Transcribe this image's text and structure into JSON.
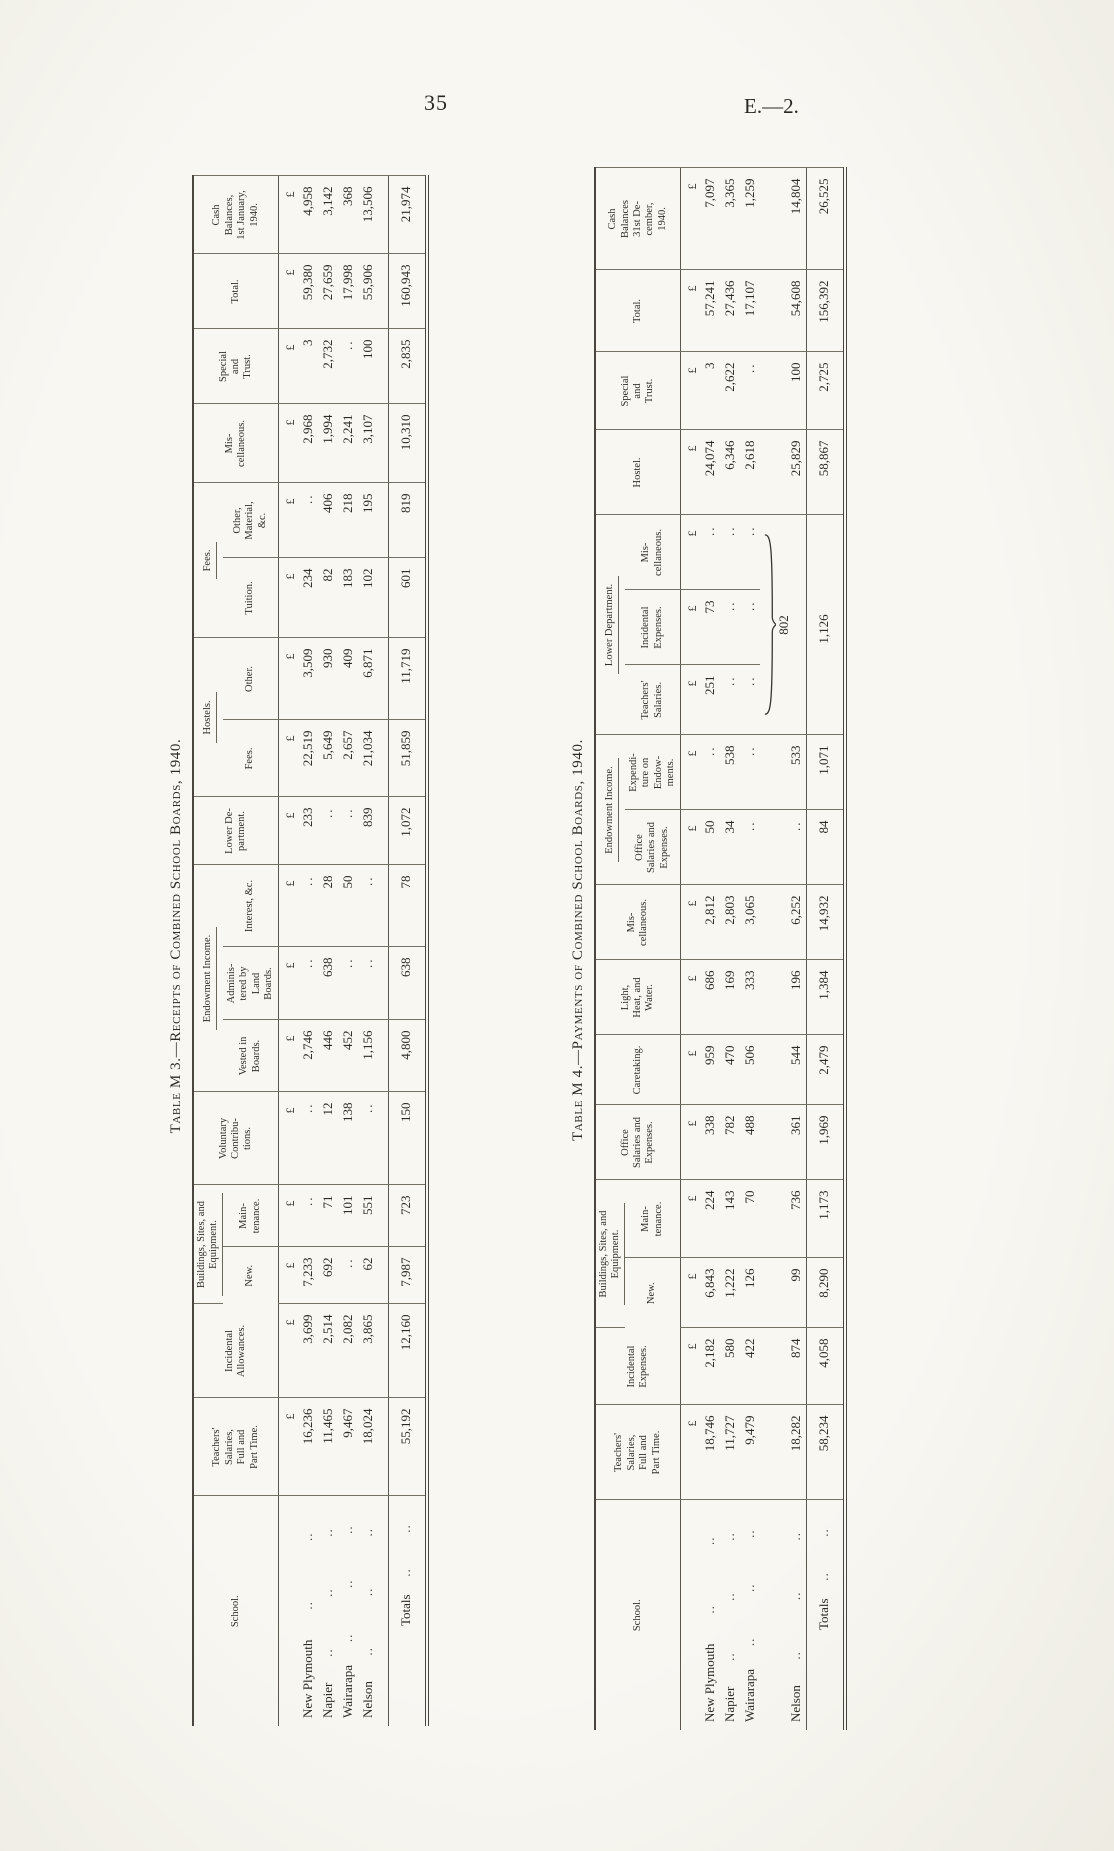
{
  "page": {
    "number": "35",
    "doc_ref": "E.—2."
  },
  "m3": {
    "caption": "Table M 3.—Receipts of Combined School Boards, 1940.",
    "currency": "£",
    "headers": {
      "school": "School.",
      "teachers": "Teachers'\nSalaries,\nFull and\nPart Time.",
      "incidental": "Incidental\nAllowances.",
      "buildings": "Buildings, Sites, and\nEquipment.",
      "bnew": "New.",
      "maint": "Main-\ntenance.",
      "voluntary": "Voluntary\nContribu-\ntions.",
      "endowment": "Endowment Income.",
      "vested": "Vested in\nBoards.",
      "admin": "Adminis-\ntered by\nLand\nBoards.",
      "interest": "Interest, &c.",
      "lower": "Lower De-\npartment.",
      "hostels": "Hostels.",
      "hfees": "Fees.",
      "hother": "Other.",
      "fees": "Fees.",
      "tuition": "Tuition.",
      "othermat": "Other,\nMaterial,\n&c.",
      "misc": "Mis-\ncellaneous.",
      "special": "Special\nand\nTrust.",
      "total": "Total.",
      "cash": "Cash\nBalances,\n1st January,\n1940."
    },
    "rows": [
      {
        "school": "New Plymouth",
        "dots": [
          "..",
          ".."
        ],
        "values": [
          "16,236",
          "3,699",
          "7,233",
          "..",
          "..",
          "2,746",
          "..",
          "..",
          "233",
          "22,519",
          "3,509",
          "234",
          "..",
          "2,968",
          "3",
          "59,380",
          "4,958"
        ]
      },
      {
        "school": "Napier",
        "dots": [
          "..",
          "..",
          ".."
        ],
        "values": [
          "11,465",
          "2,514",
          "692",
          "71",
          "12",
          "446",
          "638",
          "28",
          "..",
          "5,649",
          "930",
          "82",
          "406",
          "1,994",
          "2,732",
          "27,659",
          "3,142"
        ]
      },
      {
        "school": "Wairarapa",
        "dots": [
          "..",
          "..",
          ".."
        ],
        "values": [
          "9,467",
          "2,082",
          "..",
          "101",
          "138",
          "452",
          "..",
          "50",
          "..",
          "2,657",
          "409",
          "183",
          "218",
          "2,241",
          "..",
          "17,998",
          "368"
        ]
      },
      {
        "school": "Nelson",
        "dots": [
          "..",
          "..",
          ".."
        ],
        "values": [
          "18,024",
          "3,865",
          "62",
          "551",
          "..",
          "1,156",
          "..",
          "..",
          "839",
          "21,034",
          "6,871",
          "102",
          "195",
          "3,107",
          "100",
          "55,906",
          "13,506"
        ]
      }
    ],
    "totals": {
      "school": "Totals",
      "dots": [
        "..",
        ".."
      ],
      "values": [
        "55,192",
        "12,160",
        "7,987",
        "723",
        "150",
        "4,800",
        "638",
        "78",
        "1,072",
        "51,859",
        "11,719",
        "601",
        "819",
        "10,310",
        "2,835",
        "160,943",
        "21,974"
      ]
    }
  },
  "m4": {
    "caption": "Table M 4.—Payments of Combined School Boards, 1940.",
    "currency": "£",
    "headers": {
      "school": "School.",
      "teachers": "Teachers'\nSalaries,\nFull and\nPart Time.",
      "incexp": "Incidental\nExpenses.",
      "buildings": "Buildings, Sites, and\nEquipment.",
      "bnew": "New.",
      "maint": "Main-\ntenance.",
      "office": "Office\nSalaries and\nExpenses.",
      "caretaking": "Caretaking.",
      "light": "Light,\nHeat, and\nWater.",
      "misc": "Mis-\ncellaneous.",
      "endowment": "Endowment Income.",
      "eoffice": "Office\nSalaries and\nExpenses.",
      "eexpend": "Expendi-\nture on\nEndow-\nments.",
      "lower": "Lower Department.",
      "ldteach": "Teachers'\nSalaries.",
      "ldinc": "Incidental\nExpenses.",
      "ldmisc": "Mis-\ncellaneous.",
      "hostel": "Hostel.",
      "special": "Special\nand\nTrust.",
      "total": "Total.",
      "cash": "Cash\nBalances\n31st De-\ncember,\n1940."
    },
    "rows": [
      {
        "school": "New Plymouth",
        "dots": [
          "..",
          ".."
        ],
        "values": [
          "18,746",
          "2,182",
          "6,843",
          "224",
          "338",
          "959",
          "686",
          "2,812",
          "50",
          "..",
          "251",
          "73",
          "..",
          "24,074",
          "3",
          "57,241",
          "7,097"
        ]
      },
      {
        "school": "Napier",
        "dots": [
          "..",
          "..",
          ".."
        ],
        "values": [
          "11,727",
          "580",
          "1,222",
          "143",
          "782",
          "470",
          "169",
          "2,803",
          "34",
          "538",
          "..",
          "..",
          "..",
          "6,346",
          "2,622",
          "27,436",
          "3,365"
        ]
      },
      {
        "school": "Wairarapa",
        "dots": [
          "..",
          "..",
          ".."
        ],
        "values": [
          "9,479",
          "422",
          "126",
          "70",
          "488",
          "506",
          "333",
          "3,065",
          "..",
          "..",
          "..",
          "..",
          "..",
          "2,618",
          "..",
          "17,107",
          "1,259"
        ]
      },
      {
        "school": "Nelson",
        "dots": [
          "..",
          "..",
          ".."
        ],
        "values": [
          "18,282",
          "874",
          "99",
          "736",
          "361",
          "544",
          "196",
          "6,252",
          "..",
          "533",
          "",
          "",
          "",
          "25,829",
          "100",
          "54,608",
          "14,804"
        ],
        "merge": {
          "at": 10,
          "span": 3,
          "value": "802",
          "brace": true
        }
      }
    ],
    "totals": {
      "school": "Totals",
      "dots": [
        "..",
        ".."
      ],
      "values": [
        "58,234",
        "4,058",
        "8,290",
        "1,173",
        "1,969",
        "2,479",
        "1,384",
        "14,932",
        "84",
        "1,071",
        "",
        "",
        "",
        "58,867",
        "2,725",
        "156,392",
        "26,525"
      ],
      "merge": {
        "at": 10,
        "span": 3,
        "value": "1,126",
        "brace": false
      }
    }
  }
}
